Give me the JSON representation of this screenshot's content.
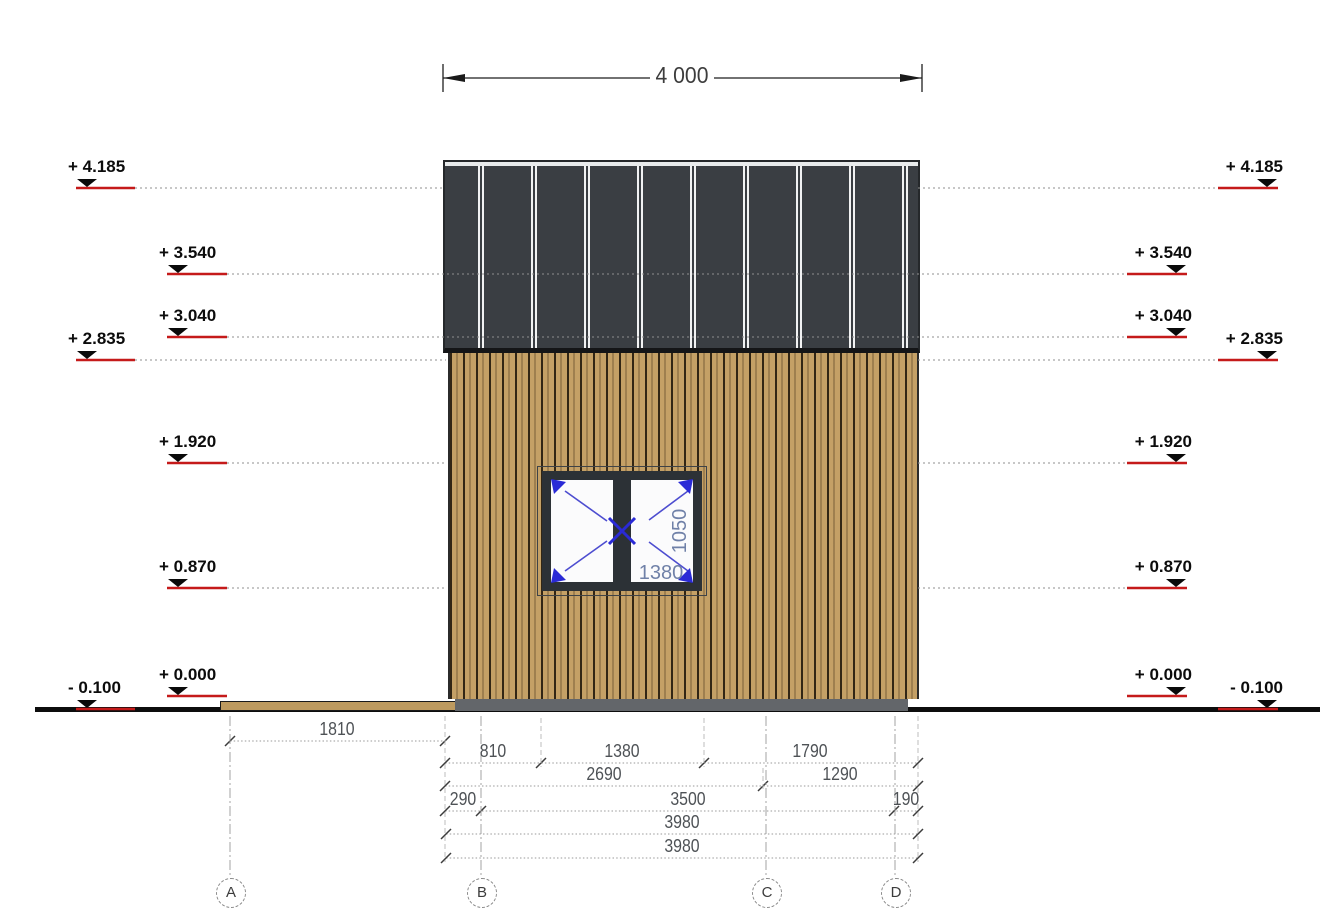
{
  "drawing": {
    "type": "architectural-elevation",
    "top_dimension": "4 000",
    "elevation_labels_left": [
      "+ 4.185",
      "+ 3.540",
      "+ 3.040",
      "+ 2.835",
      "+ 1.920",
      "+ 0.870",
      "+ 0.000",
      "- 0.100"
    ],
    "elevation_labels_right": [
      "+ 4.185",
      "+ 3.540",
      "+ 3.040",
      "+ 2.835",
      "+ 1.920",
      "+ 0.870",
      "+ 0.000",
      "- 0.100"
    ],
    "window_annotations": {
      "width": "1380",
      "height": "1050"
    },
    "dim_rows": {
      "row1": [
        "1810"
      ],
      "row2": [
        "810",
        "1380",
        "1790"
      ],
      "row3": [
        "2690",
        "1290"
      ],
      "row4": [
        "290",
        "3500",
        "190"
      ],
      "row5": [
        "3980"
      ],
      "row6": [
        "3980"
      ]
    },
    "grid_labels": [
      "A",
      "B",
      "C",
      "D"
    ],
    "colors": {
      "roof": "#3a3e43",
      "roof_seam_stripe": "#f1f2f3",
      "timber_cladding": "#c4a066",
      "foundation_gray": "#63666a",
      "terrace_wood": "#bd9a5f",
      "level_marker_red": "#c51a1a",
      "window_frame": "#2c3136",
      "window_annotation_blue": "#2a2ad6",
      "window_dim_text_blue": "#7081a8"
    }
  }
}
